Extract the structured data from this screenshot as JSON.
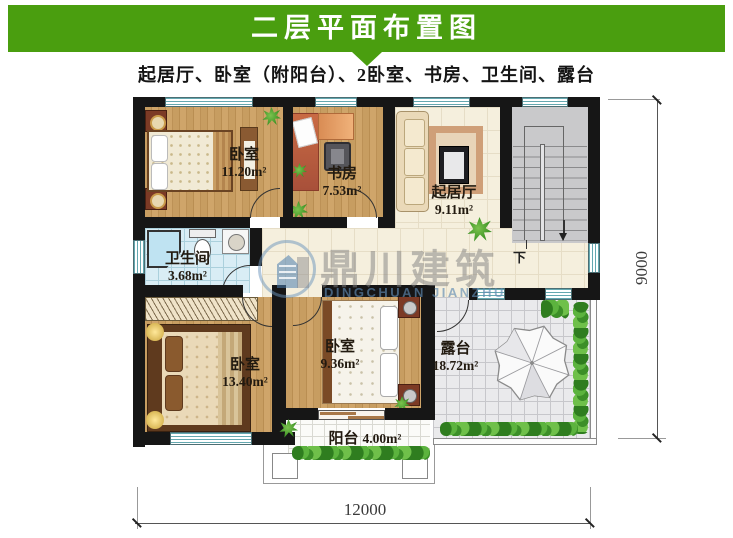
{
  "banner": {
    "title": "二层平面布置图",
    "bg_color": "#4a9e0f"
  },
  "subtitle": {
    "text": "起居厅、卧室（附阳台）、2卧室、书房、卫生间、露台"
  },
  "watermark": {
    "name": "鼎川建筑",
    "latin": "DINGCHUAN JIANZHU"
  },
  "rooms": {
    "bedroom_top": {
      "name": "卧室",
      "area": "11.20m²"
    },
    "study": {
      "name": "书房",
      "area": "7.53m²"
    },
    "living": {
      "name": "起居厅",
      "area": "9.11m²"
    },
    "bathroom": {
      "name": "卫生间",
      "area": "3.68m²"
    },
    "bedroom_left": {
      "name": "卧室",
      "area": "13.40m²"
    },
    "bedroom_mid": {
      "name": "卧室",
      "area": "9.36m²"
    },
    "terrace": {
      "name": "露台",
      "area": "18.72m²"
    },
    "balcony": {
      "name": "阳台",
      "area": "4.00m²"
    }
  },
  "stairs": {
    "down_label": "下"
  },
  "dimensions": {
    "width_mm": "12000",
    "height_mm": "9000"
  },
  "colors": {
    "banner_green": "#4a9e0f",
    "wall": "#161616",
    "window_teal": "#64a8b0",
    "wood_floor": "#c79d61",
    "tile_cream": "#f5efdd",
    "bath_blue": "#d9edf5",
    "terrace_gray": "#eaeaec",
    "stair_gray": "#c9c9cb",
    "plant_green": "#3c8f28"
  }
}
